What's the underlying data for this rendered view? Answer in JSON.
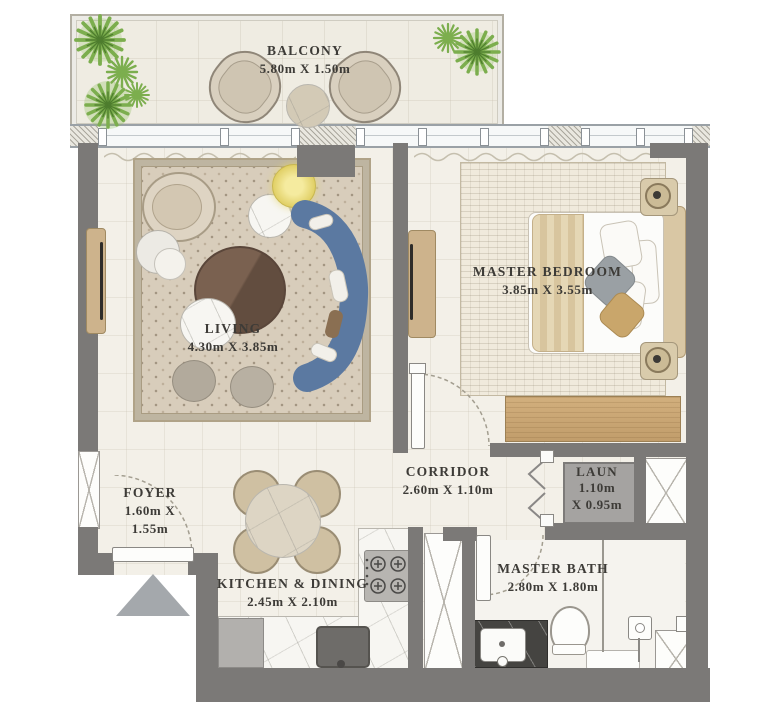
{
  "rooms": {
    "balcony": {
      "name": "BALCONY",
      "dims": "5.80m X 1.50m"
    },
    "living": {
      "name": "LIVING",
      "dims": "4.30m X 3.85m"
    },
    "master_bedroom": {
      "name": "MASTER BEDROOM",
      "dims": "3.85m X 3.55m"
    },
    "foyer": {
      "name": "FOYER",
      "dims_line1": "1.60m X",
      "dims_line2": "1.55m"
    },
    "corridor": {
      "name": "CORRIDOR",
      "dims": "2.60m X 1.10m"
    },
    "laundry": {
      "name": "LAUN",
      "dims_line1": "1.10m",
      "dims_line2": "X 0.95m"
    },
    "kitchen_dining": {
      "name": "KITCHEN & DINING",
      "dims": "2.45m X 2.10m"
    },
    "master_bath": {
      "name": "MASTER BATH",
      "dims": "2.80m X 1.80m"
    }
  },
  "colors": {
    "wall": "#7b7977",
    "floor": "#f3f0e8",
    "sofa": "#5b79a1",
    "wood": "#c9a878",
    "plant": "#7cae4e",
    "entry_arrow": "#a4a8ac"
  }
}
